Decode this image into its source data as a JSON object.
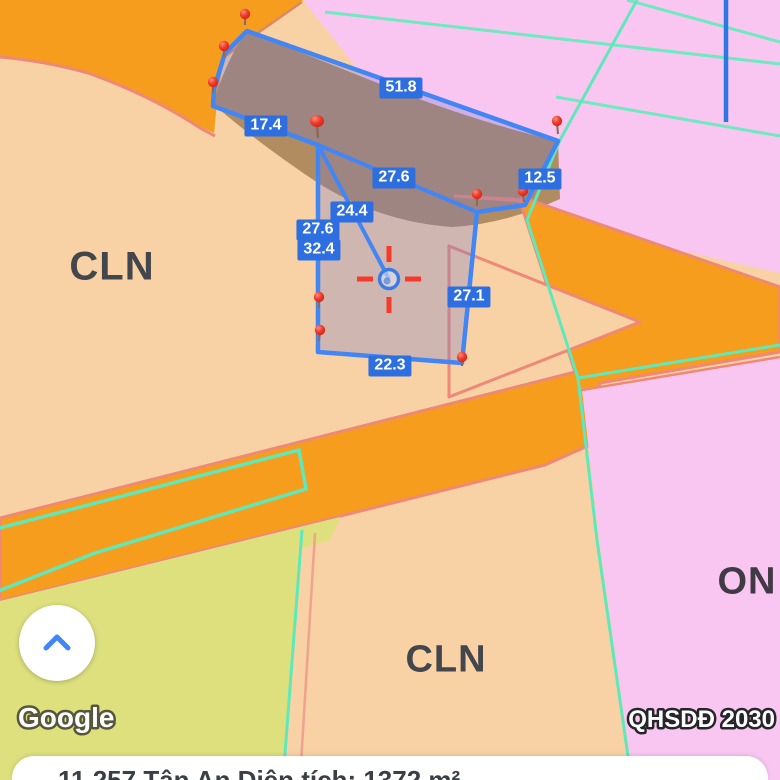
{
  "app": {
    "attribution": "Google",
    "watermark": "QHSDĐ 2030"
  },
  "map": {
    "zone_labels": [
      {
        "text": "CLN"
      },
      {
        "text": "CLN"
      },
      {
        "text": "ON"
      }
    ],
    "measurements": [
      {
        "value": "51.8"
      },
      {
        "value": "17.4"
      },
      {
        "value": "27.6"
      },
      {
        "value": "12.5"
      },
      {
        "value": "24.4"
      },
      {
        "value": "27.6"
      },
      {
        "value": "32.4"
      },
      {
        "value": "27.1"
      },
      {
        "value": "22.3"
      }
    ],
    "marker_count": 10
  },
  "info_bar": {
    "text": "11.257 Tân An   Diện tích: 1372 m²"
  },
  "controls": {
    "collapse_button": "chevron-up"
  },
  "colors": {
    "zone_peach": "#f8d2a4",
    "zone_pink": "#f9c6f2",
    "zone_yellow_green": "#dde07d",
    "zone_brown": "#b18c60",
    "road_orange": "#f79d1e",
    "road_border_salmon": "#ee8878",
    "boundary_teal": "#5fe8ba",
    "parcel_blue": "#4285f4",
    "label_blue": "#2d6fe0",
    "pin_red": "#e33024",
    "crosshair_red": "#f5392c",
    "power_line_blue": "#2b78e0"
  }
}
